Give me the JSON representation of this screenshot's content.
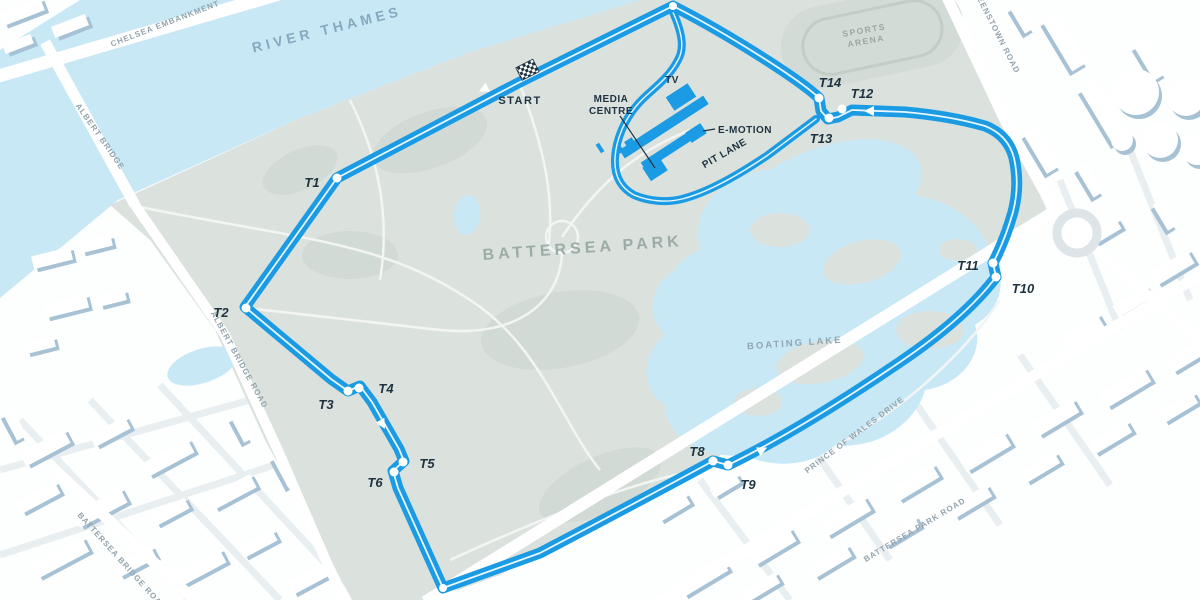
{
  "map": {
    "area_labels": {
      "river": "RIVER THAMES",
      "park": "BATTERSEA PARK",
      "lake": "BOATING LAKE",
      "arena_lines": [
        "SPORTS",
        "ARENA"
      ]
    },
    "road_labels": {
      "chelsea_embankment": "CHELSEA EMBANKMENT",
      "albert_bridge": "ALBERT BRIDGE",
      "albert_bridge_road": "ALBERT BRIDGE ROAD",
      "battersea_bridge_road": "BATTERSEA BRIDGE ROAD",
      "battersea_park_road": "BATTERSEA PARK ROAD",
      "prince_of_wales_drive": "PRINCE OF WALES DRIVE",
      "queenstown_road": "QUEENSTOWN ROAD"
    },
    "circuit": {
      "start_label": "START",
      "pit_lane_label": "PIT LANE",
      "media_centre_lines": [
        "MEDIA",
        "CENTRE"
      ],
      "tv_label": "TV",
      "emotion_label": "E-MOTION",
      "turns": [
        {
          "label": "T1",
          "dot": [
            337,
            178
          ],
          "text": [
            312,
            183
          ]
        },
        {
          "label": "T2",
          "dot": [
            246,
            308
          ],
          "text": [
            221,
            313
          ]
        },
        {
          "label": "T3",
          "dot": [
            348,
            391
          ],
          "text": [
            326,
            405
          ]
        },
        {
          "label": "T4",
          "dot": [
            359,
            388
          ],
          "text": [
            386,
            389
          ]
        },
        {
          "label": "T5",
          "dot": [
            403,
            462
          ],
          "text": [
            427,
            464
          ]
        },
        {
          "label": "T6",
          "dot": [
            394,
            472
          ],
          "text": [
            375,
            483
          ]
        },
        {
          "label": "T8",
          "dot": [
            713,
            461
          ],
          "text": [
            697,
            452
          ]
        },
        {
          "label": "T9",
          "dot": [
            728,
            465
          ],
          "text": [
            748,
            485
          ]
        },
        {
          "label": "T10",
          "dot": [
            996,
            277
          ],
          "text": [
            1023,
            289
          ]
        },
        {
          "label": "T11",
          "dot": [
            993,
            263
          ],
          "text": [
            968,
            266
          ]
        },
        {
          "label": "T12",
          "dot": [
            842,
            109
          ],
          "text": [
            862,
            94
          ]
        },
        {
          "label": "T13",
          "dot": [
            829,
            118
          ],
          "text": [
            821,
            139
          ]
        },
        {
          "label": "T14",
          "dot": [
            819,
            98
          ],
          "text": [
            830,
            83
          ]
        }
      ],
      "corner_dots": [
        [
          673,
          6
        ],
        [
          443,
          588
        ]
      ],
      "direction_arrows": [
        {
          "x": 486,
          "y": 88,
          "angle": 152
        },
        {
          "x": 381,
          "y": 422,
          "angle": 60
        },
        {
          "x": 760,
          "y": 451,
          "angle": -26
        },
        {
          "x": 872,
          "y": 111,
          "angle": 180
        }
      ]
    },
    "colors": {
      "track": "#1B9BE3",
      "water": "#C9E8F6",
      "park": "#DBE2DE",
      "label_navy": "#1E3240",
      "label_gray": "#93A3AC",
      "building_shadow": "#A7C1D5"
    }
  }
}
